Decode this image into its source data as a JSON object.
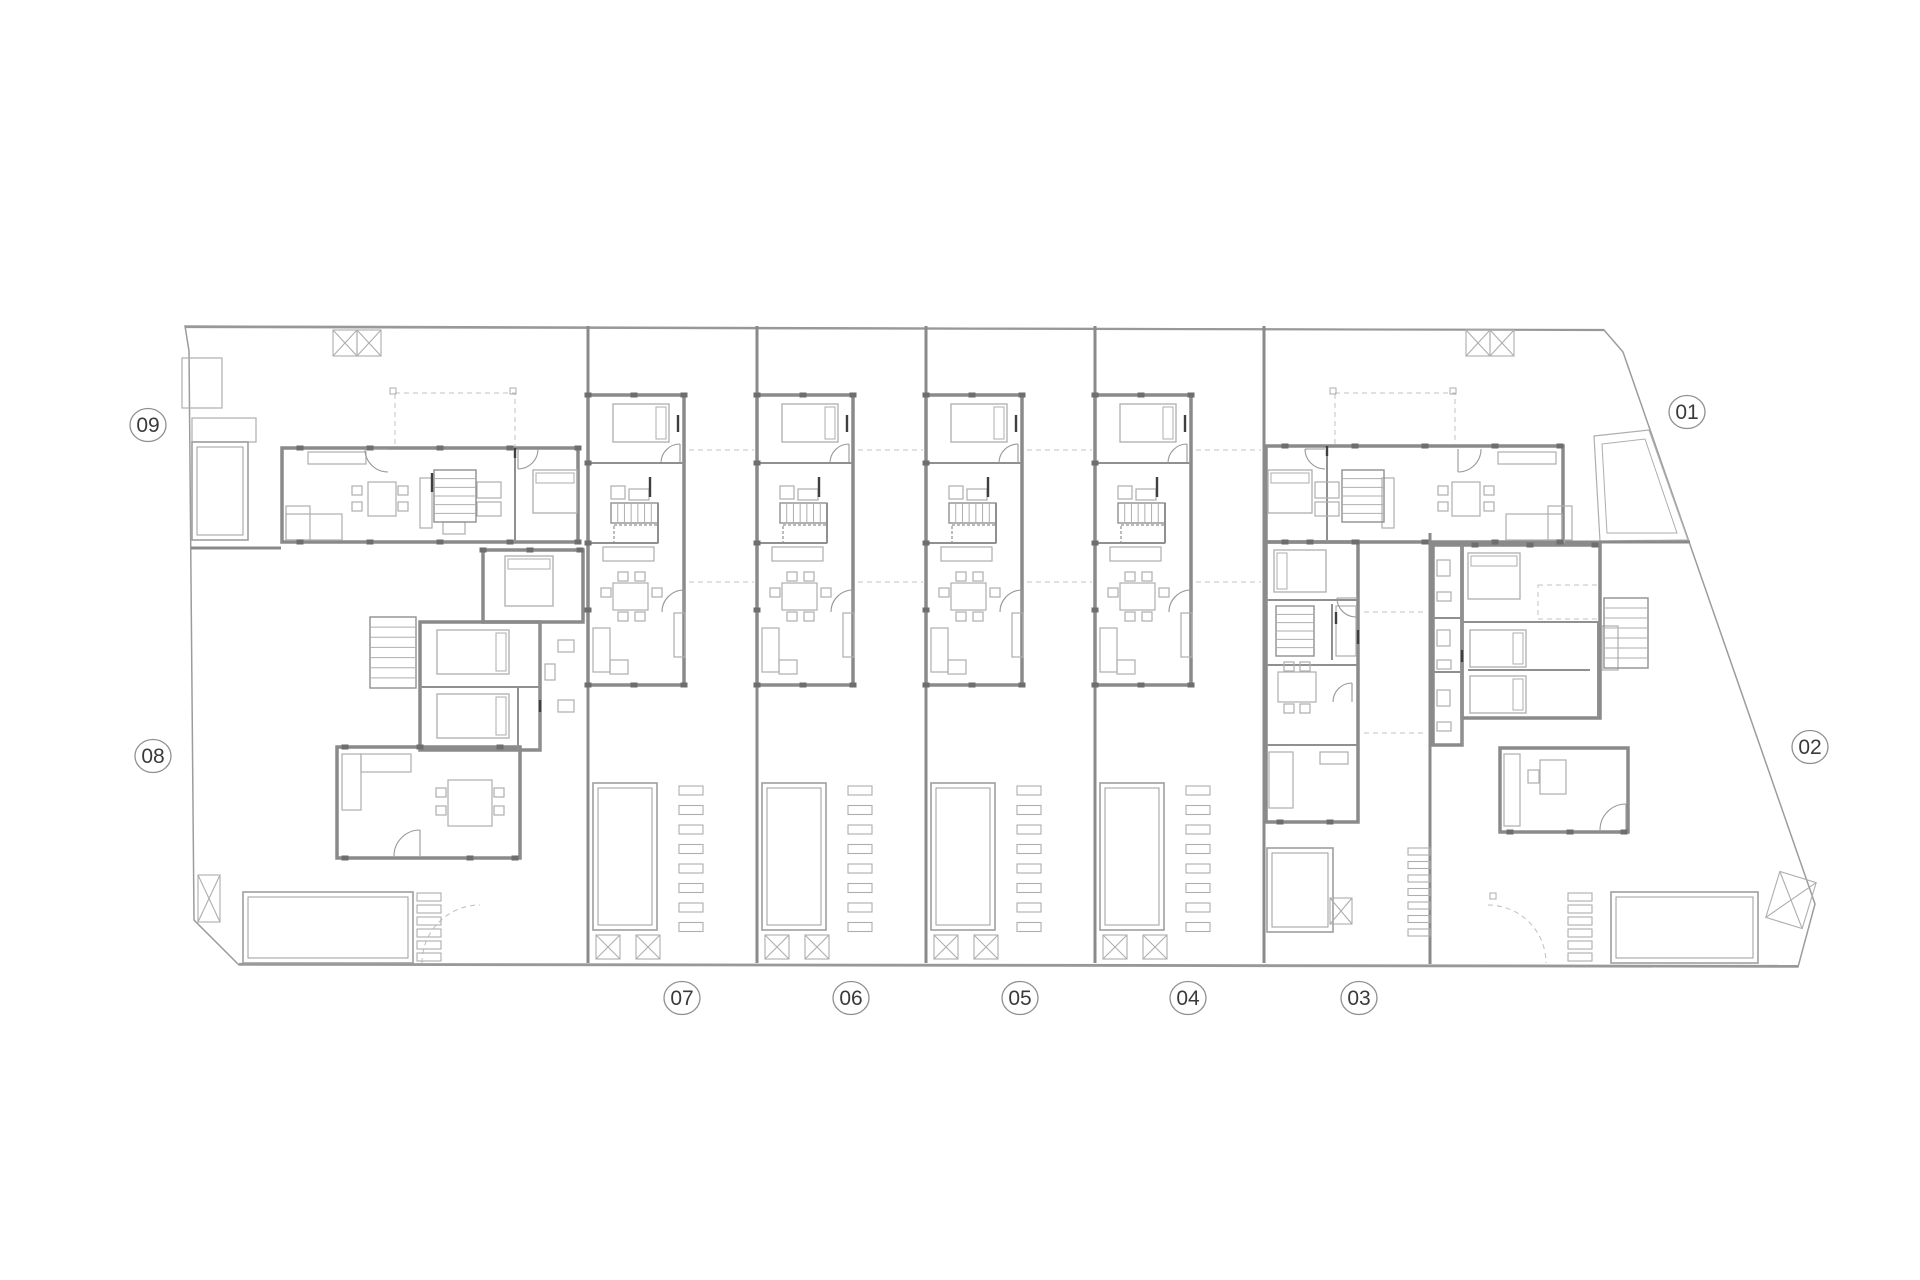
{
  "canvas": {
    "width": 1920,
    "height": 1280,
    "background": "#ffffff"
  },
  "colors": {
    "boundary": "#9c9c9c",
    "wall": "#8a8a8a",
    "wall_thin": "#989898",
    "partition": "#909090",
    "column": "#6e6e6e",
    "dark": "#3f3f3f",
    "furniture": "#aeaeae",
    "pool": "#9e9e9e",
    "dash": "#c3c3c3",
    "label_text": "#3a3a3a",
    "label_ring": "#8f8f8f"
  },
  "labels": [
    {
      "id": "09",
      "x": 148,
      "y": 425
    },
    {
      "id": "08",
      "x": 153,
      "y": 756
    },
    {
      "id": "07",
      "x": 682,
      "y": 998
    },
    {
      "id": "06",
      "x": 851,
      "y": 998
    },
    {
      "id": "05",
      "x": 1020,
      "y": 998
    },
    {
      "id": "04",
      "x": 1188,
      "y": 998
    },
    {
      "id": "03",
      "x": 1359,
      "y": 998
    },
    {
      "id": "02",
      "x": 1810,
      "y": 747
    },
    {
      "id": "01",
      "x": 1687,
      "y": 412
    }
  ],
  "label_style": {
    "rx": 18,
    "ry": 16.5,
    "font_size": 21
  },
  "site": {
    "outline": [
      [
        185,
        326
      ],
      [
        1604,
        330
      ],
      [
        1623,
        352
      ],
      [
        1815,
        904
      ],
      [
        1798,
        967
      ],
      [
        239,
        965
      ],
      [
        194,
        920
      ],
      [
        189,
        351
      ]
    ],
    "top_edge": [
      185,
      327,
      1604,
      330
    ],
    "bottom_edge": [
      239,
      964,
      1798,
      966
    ]
  },
  "strips": {
    "origins": [
      588,
      757,
      926,
      1095
    ],
    "template": {
      "outline": [
        0,
        395,
        96,
        290
      ],
      "lines": [
        [
          0,
          463,
          96,
          463
        ],
        [
          0,
          543,
          70,
          543
        ],
        [
          70,
          503,
          70,
          543
        ]
      ],
      "rects": [
        [
          23,
          486,
          14,
          13
        ],
        [
          41,
          489,
          20,
          11
        ],
        [
          15,
          547,
          51,
          14
        ],
        [
          86,
          613,
          11,
          44
        ],
        [
          25,
          583,
          35,
          27
        ],
        [
          30,
          572,
          10,
          9
        ],
        [
          47,
          572,
          10,
          9
        ],
        [
          30,
          612,
          10,
          9
        ],
        [
          47,
          612,
          10,
          9
        ],
        [
          13,
          588,
          10,
          9
        ],
        [
          64,
          588,
          10,
          9
        ],
        [
          5,
          628,
          17,
          44
        ],
        [
          22,
          660,
          18,
          14
        ]
      ],
      "bed": [
        25,
        404,
        56,
        38,
        "right"
      ],
      "stairs": [
        23,
        503,
        47,
        20,
        "h",
        7
      ],
      "landing": [
        26,
        525,
        44,
        18
      ],
      "pool": [
        5,
        783,
        64,
        147
      ],
      "slats": [
        91,
        786,
        24,
        9,
        8,
        19.5
      ],
      "xboxes": [
        [
          8,
          935,
          24,
          24
        ],
        [
          48,
          935,
          24,
          24
        ]
      ],
      "arcs": [
        [
          92,
          463,
          19,
          180,
          270
        ],
        [
          96,
          612,
          22,
          180,
          270
        ]
      ],
      "jambs": [
        [
          62,
          477,
          62,
          497
        ],
        [
          90,
          415,
          90,
          432
        ]
      ],
      "columns": [
        [
          0,
          395
        ],
        [
          46,
          395
        ],
        [
          96,
          395
        ],
        [
          0,
          685
        ],
        [
          46,
          685
        ],
        [
          96,
          685
        ],
        [
          0,
          463
        ],
        [
          0,
          543
        ],
        [
          0,
          610
        ]
      ],
      "dashes": [
        [
          101,
          450,
          166,
          450
        ],
        [
          101,
          582,
          166,
          582
        ]
      ]
    }
  },
  "walls": {
    "party": [
      [
        588,
        326,
        963
      ],
      [
        757,
        326,
        963
      ],
      [
        926,
        326,
        963
      ],
      [
        1095,
        326,
        963
      ],
      [
        1264,
        326,
        963
      ],
      [
        1430,
        533,
        964
      ]
    ],
    "lines": [
      [
        191,
        548,
        281,
        548
      ],
      [
        1565,
        542,
        1690,
        542
      ]
    ],
    "partitions": [
      [
        515,
        448,
        515,
        542
      ],
      [
        1327,
        446,
        1327,
        542
      ],
      [
        1266,
        600,
        1358,
        600
      ],
      [
        1266,
        665,
        1358,
        665
      ],
      [
        1266,
        745,
        1358,
        745
      ],
      [
        1332,
        604,
        1332,
        660
      ],
      [
        1462,
        545,
        1462,
        745
      ],
      [
        1462,
        622,
        1600,
        622
      ],
      [
        1468,
        670,
        1590,
        670
      ],
      [
        1598,
        622,
        1598,
        718
      ],
      [
        1433,
        618,
        1462,
        618
      ],
      [
        1433,
        672,
        1462,
        672
      ],
      [
        420,
        687,
        540,
        687
      ],
      [
        540,
        622,
        540,
        750
      ],
      [
        518,
        687,
        518,
        750
      ]
    ],
    "rects": [
      [
        282,
        448,
        296,
        94
      ],
      [
        1266,
        446,
        297,
        96
      ],
      [
        1266,
        542,
        92,
        280
      ],
      [
        1462,
        545,
        138,
        173
      ],
      [
        1500,
        748,
        128,
        84
      ],
      [
        1433,
        545,
        29,
        200
      ],
      [
        483,
        550,
        100,
        72
      ],
      [
        420,
        622,
        120,
        128
      ],
      [
        337,
        747,
        183,
        111
      ]
    ]
  },
  "furniture": {
    "beds": [
      [
        533,
        470,
        44,
        43,
        "top"
      ],
      [
        1268,
        470,
        44,
        43,
        "top"
      ],
      [
        1274,
        550,
        52,
        42,
        "left"
      ],
      [
        1468,
        553,
        52,
        46,
        "top"
      ],
      [
        1470,
        630,
        56,
        37,
        "right"
      ],
      [
        1470,
        676,
        56,
        37,
        "right"
      ],
      [
        505,
        556,
        48,
        50,
        "top"
      ],
      [
        437,
        630,
        72,
        44,
        "right"
      ],
      [
        437,
        694,
        72,
        44,
        "right"
      ]
    ],
    "stairs": [
      [
        434,
        470,
        42,
        52,
        "v",
        6
      ],
      [
        1342,
        470,
        42,
        52,
        "v",
        6
      ],
      [
        370,
        617,
        46,
        71,
        "v",
        7
      ],
      [
        1276,
        606,
        38,
        50,
        "v",
        6
      ],
      [
        1604,
        598,
        44,
        70,
        "v",
        7
      ]
    ],
    "rects": [
      [
        308,
        452,
        58,
        12
      ],
      [
        368,
        482,
        28,
        34
      ],
      [
        352,
        486,
        10,
        9
      ],
      [
        352,
        502,
        10,
        9
      ],
      [
        398,
        486,
        10,
        9
      ],
      [
        398,
        502,
        10,
        9
      ],
      [
        286,
        506,
        24,
        34
      ],
      [
        286,
        514,
        56,
        26
      ],
      [
        420,
        478,
        12,
        50
      ],
      [
        477,
        482,
        24,
        16
      ],
      [
        477,
        502,
        24,
        14
      ],
      [
        443,
        522,
        22,
        12
      ],
      [
        1498,
        452,
        58,
        12
      ],
      [
        1452,
        482,
        28,
        34
      ],
      [
        1438,
        486,
        10,
        9
      ],
      [
        1438,
        502,
        10,
        9
      ],
      [
        1484,
        486,
        10,
        9
      ],
      [
        1484,
        502,
        10,
        9
      ],
      [
        1548,
        506,
        24,
        34
      ],
      [
        1506,
        514,
        56,
        26
      ],
      [
        1382,
        478,
        12,
        50
      ],
      [
        1315,
        482,
        24,
        16
      ],
      [
        1315,
        502,
        24,
        14
      ],
      [
        1336,
        606,
        20,
        50
      ],
      [
        1278,
        672,
        38,
        30
      ],
      [
        1284,
        662,
        10,
        9
      ],
      [
        1300,
        662,
        10,
        9
      ],
      [
        1284,
        704,
        10,
        9
      ],
      [
        1300,
        704,
        10,
        9
      ],
      [
        1269,
        752,
        24,
        56
      ],
      [
        1320,
        752,
        28,
        12
      ],
      [
        1437,
        560,
        13,
        16
      ],
      [
        1437,
        592,
        14,
        9
      ],
      [
        1437,
        630,
        13,
        16
      ],
      [
        1437,
        660,
        14,
        9
      ],
      [
        1437,
        690,
        13,
        16
      ],
      [
        1437,
        722,
        14,
        9
      ],
      [
        1504,
        754,
        16,
        72
      ],
      [
        1540,
        760,
        26,
        34
      ],
      [
        1528,
        770,
        11,
        13
      ],
      [
        1602,
        626,
        16,
        44
      ],
      [
        558,
        640,
        16,
        12
      ],
      [
        558,
        700,
        16,
        12
      ],
      [
        545,
        664,
        10,
        16
      ],
      [
        342,
        754,
        19,
        56
      ],
      [
        361,
        754,
        50,
        18
      ],
      [
        448,
        780,
        44,
        46
      ],
      [
        436,
        788,
        10,
        9
      ],
      [
        436,
        806,
        10,
        9
      ],
      [
        494,
        788,
        10,
        9
      ],
      [
        494,
        806,
        10,
        9
      ],
      [
        192,
        418,
        64,
        24
      ],
      [
        182,
        358,
        40,
        50
      ]
    ]
  },
  "outdoor": {
    "pools": [
      [
        192,
        442,
        56,
        98
      ],
      [
        243,
        892,
        170,
        71
      ],
      [
        1267,
        848,
        66,
        84
      ],
      [
        1611,
        892,
        147,
        71
      ]
    ],
    "slat_groups": [
      [
        417,
        893,
        24,
        8,
        6,
        12
      ],
      [
        1568,
        893,
        24,
        8,
        6,
        12
      ],
      [
        1408,
        848,
        22,
        7,
        7,
        13.5
      ]
    ],
    "xboxes": [
      [
        333,
        330,
        24,
        26,
        0
      ],
      [
        357,
        330,
        24,
        26,
        0
      ],
      [
        1466,
        330,
        24,
        26,
        0
      ],
      [
        1490,
        330,
        24,
        26,
        0
      ],
      [
        198,
        875,
        22,
        47,
        0
      ],
      [
        1330,
        898,
        22,
        26,
        0
      ],
      [
        1772,
        876,
        38,
        48,
        17
      ]
    ],
    "terrace_outer": [
      [
        1594,
        436
      ],
      [
        1649,
        430
      ],
      [
        1688,
        540
      ],
      [
        1600,
        541
      ]
    ],
    "terrace_inner": [
      [
        1602,
        444
      ],
      [
        1645,
        439
      ],
      [
        1677,
        533
      ],
      [
        1607,
        533
      ]
    ]
  },
  "arcs": [
    [
      388,
      449,
      23,
      90,
      180
    ],
    [
      1458,
      449,
      23,
      0,
      90
    ],
    [
      518,
      449,
      20,
      0,
      90
    ],
    [
      1325,
      449,
      20,
      90,
      180
    ],
    [
      420,
      856,
      26,
      180,
      270
    ],
    [
      1626,
      830,
      26,
      180,
      270
    ],
    [
      1356,
      598,
      19,
      90,
      180
    ],
    [
      1352,
      702,
      19,
      180,
      270
    ]
  ],
  "jambs": [
    [
      432,
      473,
      432,
      492
    ],
    [
      515,
      448,
      515,
      458
    ],
    [
      1327,
      446,
      1327,
      456
    ],
    [
      1336,
      612,
      1336,
      624
    ],
    [
      1462,
      650,
      1462,
      662
    ],
    [
      540,
      700,
      540,
      712
    ],
    [
      1358,
      630,
      1358,
      644
    ]
  ],
  "columns": [
    [
      300,
      448
    ],
    [
      370,
      448
    ],
    [
      440,
      448
    ],
    [
      510,
      448
    ],
    [
      578,
      448
    ],
    [
      300,
      542
    ],
    [
      370,
      542
    ],
    [
      440,
      542
    ],
    [
      510,
      542
    ],
    [
      578,
      542
    ],
    [
      1285,
      446
    ],
    [
      1355,
      446
    ],
    [
      1425,
      446
    ],
    [
      1495,
      446
    ],
    [
      1560,
      446
    ],
    [
      1285,
      542
    ],
    [
      1355,
      542
    ],
    [
      1425,
      542
    ],
    [
      1495,
      542
    ],
    [
      1560,
      542
    ],
    [
      1310,
      542
    ],
    [
      1356,
      542
    ],
    [
      1280,
      822
    ],
    [
      1330,
      822
    ],
    [
      1475,
      545
    ],
    [
      1530,
      545
    ],
    [
      1595,
      545
    ],
    [
      1510,
      832
    ],
    [
      1570,
      832
    ],
    [
      1624,
      832
    ],
    [
      345,
      747
    ],
    [
      420,
      747
    ],
    [
      500,
      747
    ],
    [
      345,
      858
    ],
    [
      470,
      858
    ],
    [
      515,
      858
    ],
    [
      483,
      550
    ],
    [
      530,
      550
    ],
    [
      580,
      550
    ]
  ],
  "dashes": {
    "lines": [
      [
        1364,
        612,
        1426,
        612
      ],
      [
        1364,
        733,
        1426,
        733
      ]
    ],
    "rects": [
      [
        395,
        393,
        120,
        54
      ],
      [
        1335,
        393,
        120,
        54
      ],
      [
        1538,
        585,
        62,
        34
      ]
    ],
    "arcs": [
      [
        480,
        963,
        58,
        180,
        270
      ],
      [
        1488,
        963,
        58,
        270,
        360
      ]
    ],
    "dots": [
      [
        393,
        391
      ],
      [
        513,
        391
      ],
      [
        1333,
        391
      ],
      [
        1453,
        391
      ],
      [
        1493,
        896
      ]
    ]
  }
}
